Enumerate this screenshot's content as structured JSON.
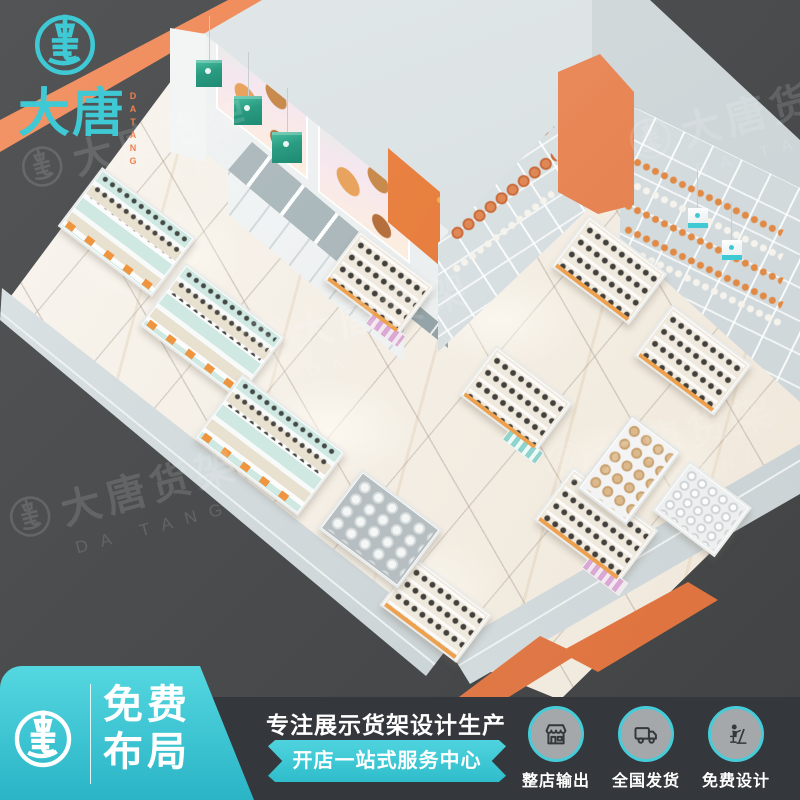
{
  "brand": {
    "name": "大唐",
    "latin": "DATANG"
  },
  "watermark": {
    "text": "大唐货架",
    "latin": "DA TANG"
  },
  "footer": {
    "badge": {
      "line1": "免费",
      "line2": "布局"
    },
    "tagline": "专注展示货架设计生产",
    "ribbon": "开店一站式服务中心",
    "features": [
      {
        "icon": "storefront-icon",
        "label": "整店输出"
      },
      {
        "icon": "truck-icon",
        "label": "全国发货"
      },
      {
        "icon": "designer-icon",
        "label": "免费设计"
      }
    ]
  },
  "colors": {
    "teal": "#3ec9d4",
    "teal_deep": "#2ab4c6",
    "orange": "#ee8150",
    "orange_deep": "#db6f3a",
    "bar_dark": "#34373b",
    "outside": "#4a4c4e",
    "wall_light": "#d9e0e2",
    "floor_light": "#f6f1e8",
    "sign_green": "#2aa38b",
    "circle_gray": "#a4a8ab"
  }
}
